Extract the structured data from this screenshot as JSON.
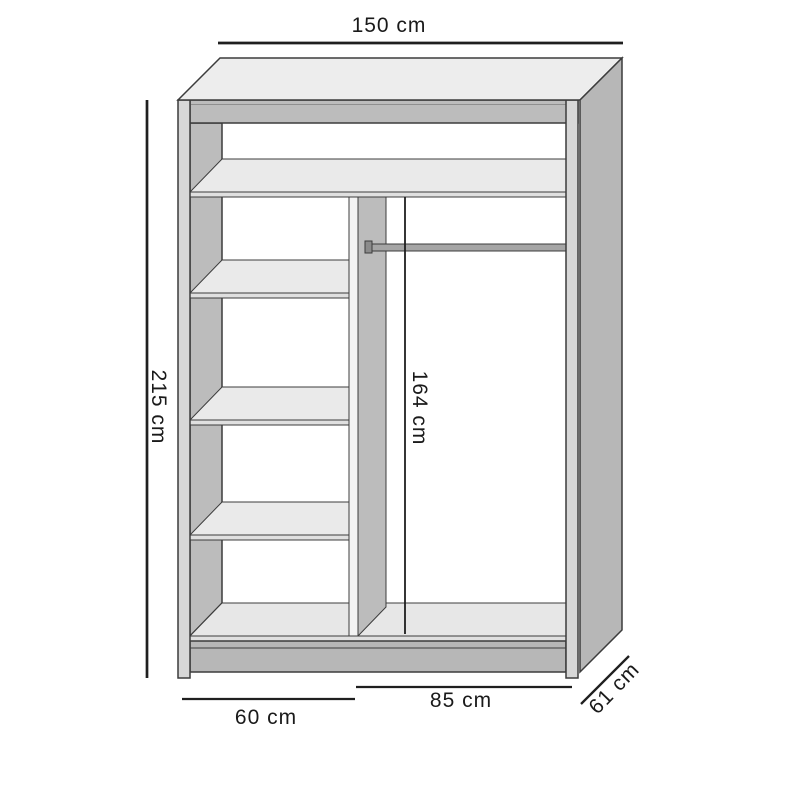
{
  "diagram": {
    "dimensions": {
      "width": "150 cm",
      "height": "215 cm",
      "inner_height": "164 cm",
      "left_section_width": "60 cm",
      "right_section_width": "85 cm",
      "depth": "61 cm"
    }
  },
  "colors": {
    "background": "#ffffff",
    "outline": "#3c3c3c",
    "bevel": "#8f8f8f",
    "dim-line": "#1f1f1f",
    "label": "#1a1a1a",
    "face-top": "#ededed",
    "face-side": "#b7b7b7",
    "panel": "#bcbcbc",
    "shelf": "#eaeaea",
    "edge": "#e0e0e0",
    "floor": "#e7e7e7",
    "plinth": "#b7b7b7",
    "stile": "#d7d7d7",
    "strip": "#f3f3f3",
    "rod": "#a5a5a5",
    "rod-cap": "#8b8b8b",
    "interior": "#ffffff"
  }
}
